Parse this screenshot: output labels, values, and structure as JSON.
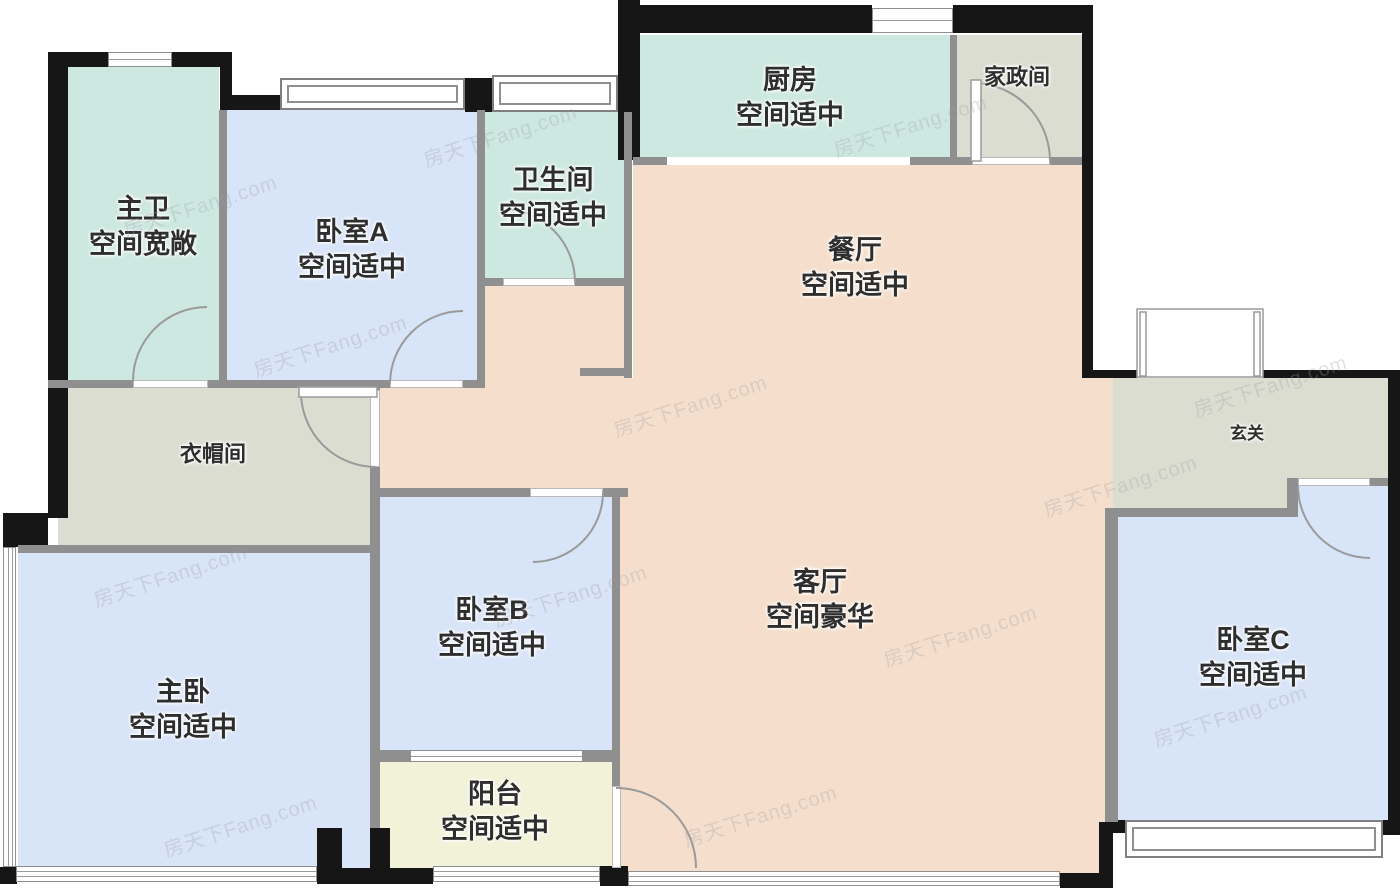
{
  "title": "户型图",
  "watermark": {
    "text": "房天下Fang.com"
  },
  "colors": {
    "wall_interior": "#8f8f8f",
    "wall_exterior": "#161616",
    "floor_bedroom": "#d8e4f8",
    "floor_bath_kitchen": "#cde8e0",
    "floor_living_dining": "#f5dfcc",
    "floor_service_gray": "#dbddd1",
    "floor_balcony": "#f2f2d9",
    "label_text": "#2e2e2e",
    "watermark_gray": "#b9b9b9"
  },
  "rooms": {
    "zhuwei": {
      "name": "主卫",
      "note": "空间宽敞"
    },
    "bedroom_a": {
      "name": "卧室A",
      "note": "空间适中"
    },
    "bathroom": {
      "name": "卫生间",
      "note": "空间适中"
    },
    "kitchen": {
      "name": "厨房",
      "note": "空间适中"
    },
    "housekeeping": {
      "name": "家政间"
    },
    "dining": {
      "name": "餐厅",
      "note": "空间适中"
    },
    "entry": {
      "name": "玄关"
    },
    "cloakroom": {
      "name": "衣帽间"
    },
    "bedroom_b": {
      "name": "卧室B",
      "note": "空间适中"
    },
    "living": {
      "name": "客厅",
      "note": "空间豪华"
    },
    "master": {
      "name": "主卧",
      "note": "空间适中"
    },
    "balcony": {
      "name": "阳台",
      "note": "空间适中"
    },
    "bedroom_c": {
      "name": "卧室C",
      "note": "空间适中"
    }
  }
}
